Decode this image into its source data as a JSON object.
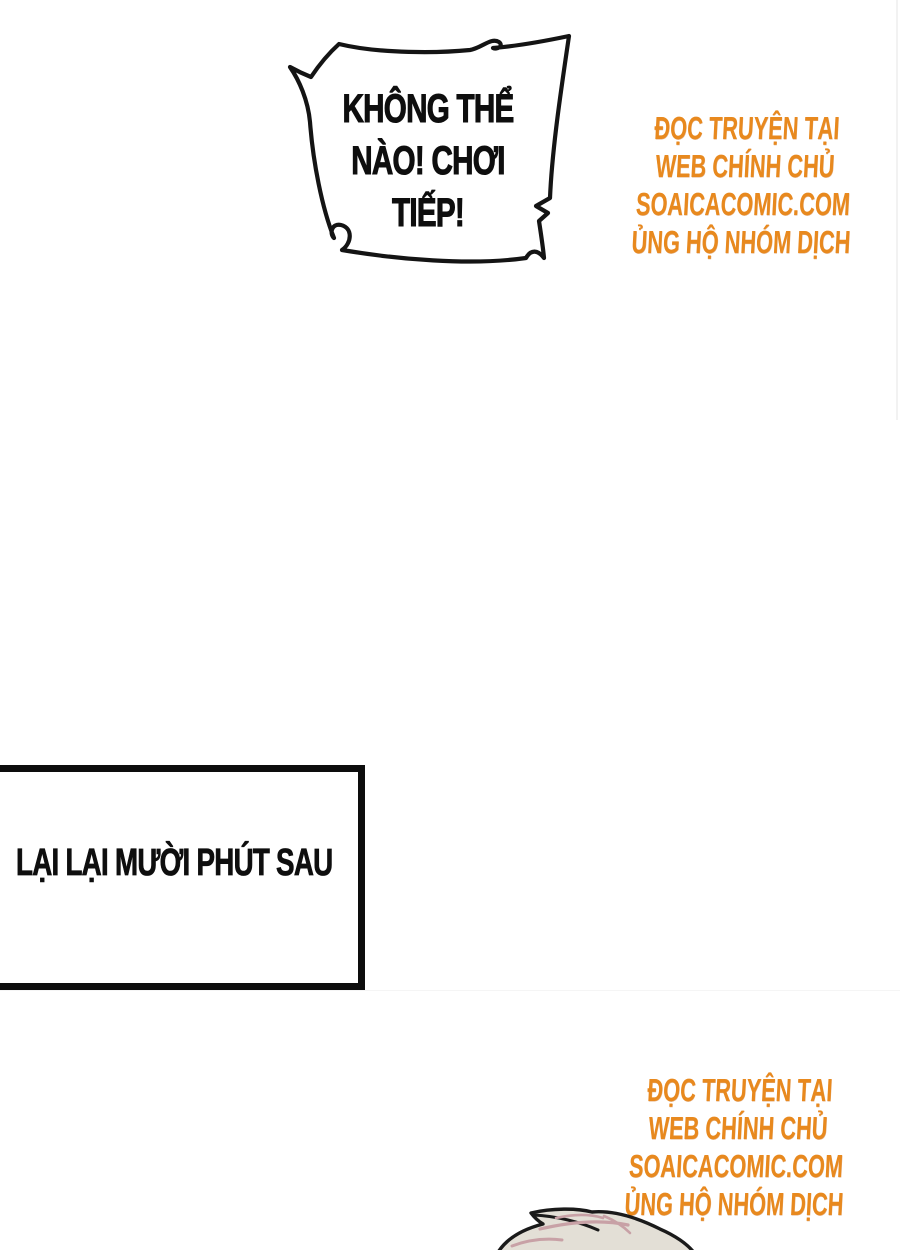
{
  "page": {
    "width": 900,
    "height": 1250,
    "background": "#ffffff"
  },
  "speech_bubble": {
    "lines": [
      "KHÔNG THỂ",
      "NÀO! CHƠI",
      "TIẾP!"
    ]
  },
  "caption_box": {
    "text": "LẠI LẠI MƯỜI PHÚT SAU"
  },
  "watermark": {
    "color": "#E8891E",
    "lines": [
      "ĐỌC TRUYỆN TẠI",
      "WEB CHÍNH CHỦ",
      "SOAICACOMIC.COM",
      "ỦNG HỘ NHÓM DỊCH"
    ]
  },
  "artwork": {
    "hair_fill": "#E3DFD6",
    "hair_highlight": "#C8A1A6",
    "outline": "#1A1A1A",
    "bubble_fill": "#FFFFFF"
  }
}
